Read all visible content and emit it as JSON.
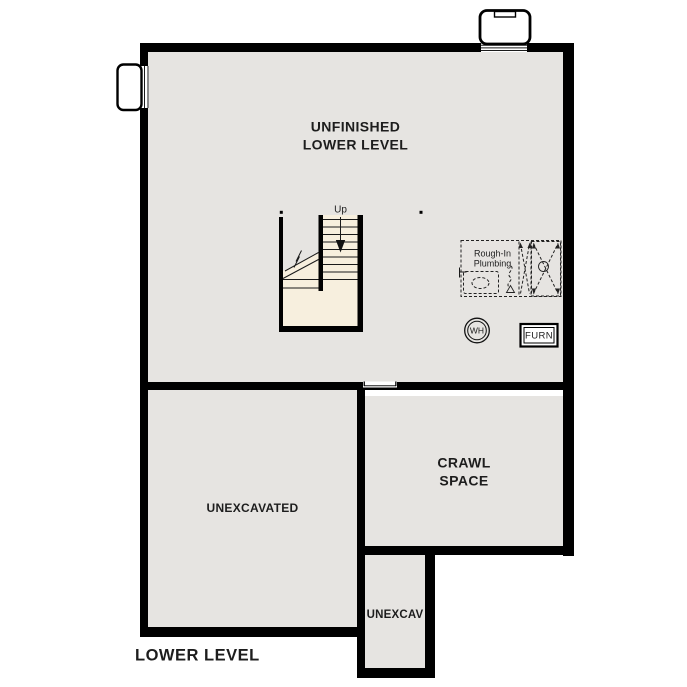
{
  "plan": {
    "title": "LOWER LEVEL",
    "labels": {
      "main_room_line1": "UNFINISHED",
      "main_room_line2": "LOWER LEVEL",
      "crawl_line1": "CRAWL",
      "crawl_line2": "SPACE",
      "unexcavated": "UNEXCAVATED",
      "unexcav_small": "UNEXCAV",
      "stairs_up": "Up",
      "plumbing_line1": "Rough-In",
      "plumbing_line2": "Plumbing",
      "water_heater": "WH",
      "furnace": "FURN"
    },
    "colors": {
      "floor_gray": "#e6e4e1",
      "stair_cream": "#f7efde",
      "wall_black": "#000000",
      "text_dark": "#1d1d1d",
      "background": "#ffffff"
    }
  }
}
